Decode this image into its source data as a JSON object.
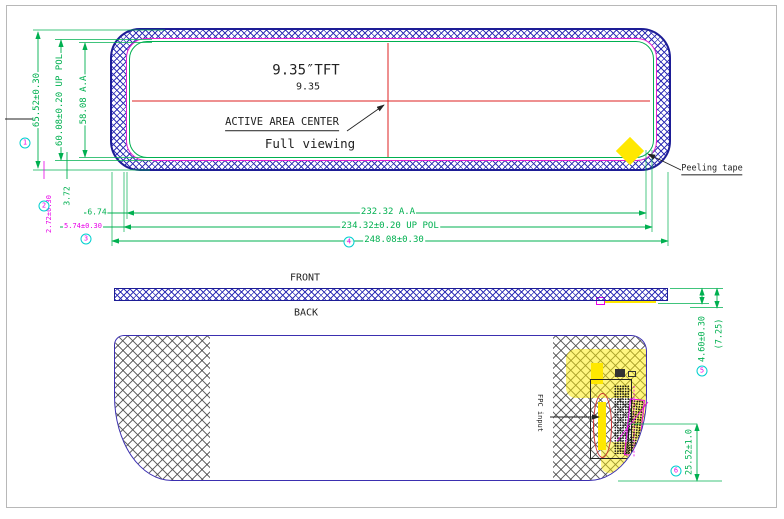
{
  "drawing": {
    "front_view": {
      "tft_size": "9.35″TFT",
      "size_value": "9.35",
      "active_area_center": "ACTIVE AREA CENTER",
      "full_viewing": "Full viewing",
      "peeling_tape": "Peeling tape",
      "dim_height_outer": "65.52±0.30",
      "dim_height_pol": "60.08±0.20 UP POL",
      "dim_height_aa": "58.08 A.A",
      "dim_3_72": "3.72",
      "dim_2_72": "2.72±0.30",
      "dim_5_74": "5.74±0.30",
      "dim_6_74": "6.74",
      "dim_width_aa": "232.32 A.A",
      "dim_width_pol": "234.32±0.20 UP POL",
      "dim_width_outer": "248.08±0.30",
      "balloon_height_outer": "1",
      "balloon_2_72": "2",
      "balloon_5_74": "3",
      "balloon_width_outer": "4"
    },
    "side_view": {
      "front_label": "FRONT",
      "back_label": "BACK",
      "dim_thickness": "4.60±0.30",
      "dim_ref": "(7.25)",
      "balloon_thickness": "5"
    },
    "back_view": {
      "fpc_label": "FPC input",
      "dim_fpc": "25.52±1.0",
      "balloon_fpc": "6"
    },
    "colors": {
      "dimension_green": "#00b050",
      "magenta": "#e800e8",
      "centerline_red": "#dd2222",
      "hatch_blue": "#2b2bb4",
      "outline_navy": "#1d1d96",
      "back_outline_purple": "#3b2fb0",
      "tape_yellow": "#ffe800",
      "balloon_cyan": "#00cfcf"
    }
  }
}
